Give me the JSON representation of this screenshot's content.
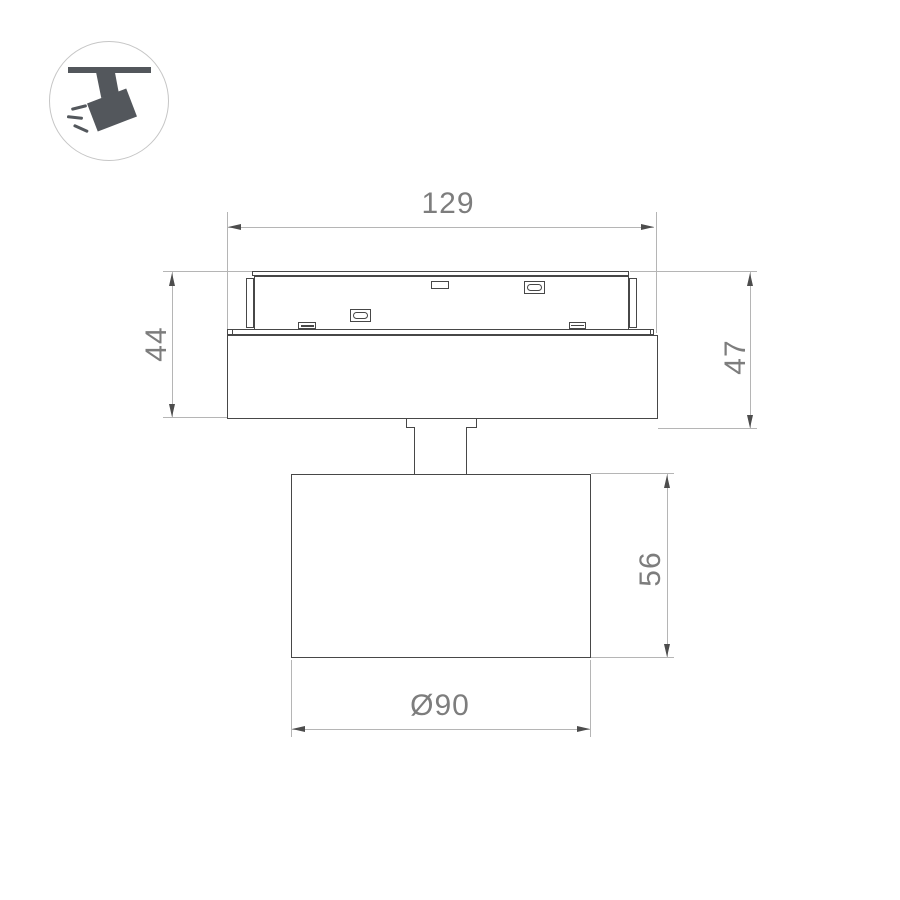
{
  "title": "Track spotlight technical drawing",
  "colors": {
    "outline": "#474747",
    "dim_line": "#b5b5b5",
    "arrow": "#4d4d4d",
    "dim_text": "#7d7d7d",
    "icon_fill": "#53575c",
    "icon_ring": "#c6c6c6",
    "bg": "#ffffff"
  },
  "icon": {
    "name": "ceiling-track-spotlight-pictogram"
  },
  "dimensions": {
    "adapter_width": {
      "label": "129"
    },
    "adapter_height_left": {
      "label": "44"
    },
    "total_height_right": {
      "label": "47"
    },
    "head_height": {
      "label": "56"
    },
    "head_diameter": {
      "label": "Ø90"
    }
  }
}
